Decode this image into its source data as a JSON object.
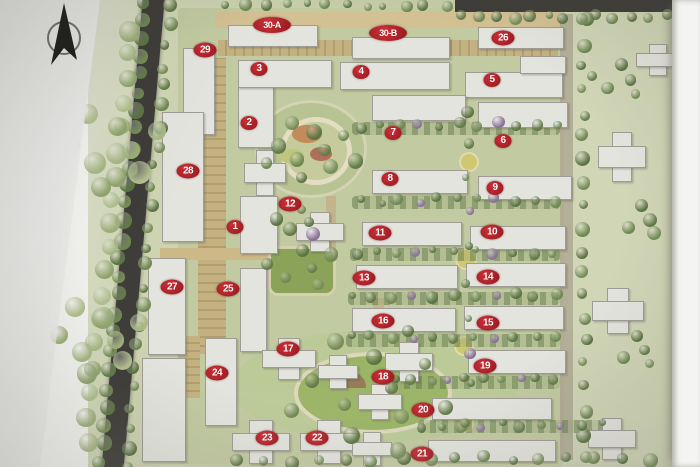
{
  "photo": {
    "kind": "residential-community-master-plan-photo",
    "compass": "north-arrow",
    "paper_color": "#f2f2ef",
    "colors": {
      "marker_red": "#a01d24",
      "marker_text": "#ffffff",
      "road_dark": "#3b3933",
      "ground_green": "#c8d2a0",
      "east_green": "#d6dcb4",
      "building_white": "#ebeae3",
      "tan_road": "#d6bc7d",
      "lawn_green": "#87a848",
      "tree_green": "#5e7c3c"
    }
  },
  "map": {
    "markers": [
      {
        "label": "1",
        "x": 235,
        "y": 227
      },
      {
        "label": "2",
        "x": 249,
        "y": 123
      },
      {
        "label": "3",
        "x": 259,
        "y": 69
      },
      {
        "label": "4",
        "x": 361,
        "y": 72
      },
      {
        "label": "5",
        "x": 492,
        "y": 80
      },
      {
        "label": "6",
        "x": 503,
        "y": 141
      },
      {
        "label": "7",
        "x": 393,
        "y": 133
      },
      {
        "label": "8",
        "x": 390,
        "y": 179
      },
      {
        "label": "9",
        "x": 495,
        "y": 188
      },
      {
        "label": "10",
        "x": 492,
        "y": 232
      },
      {
        "label": "11",
        "x": 380,
        "y": 233
      },
      {
        "label": "12",
        "x": 290,
        "y": 204
      },
      {
        "label": "13",
        "x": 364,
        "y": 278
      },
      {
        "label": "14",
        "x": 488,
        "y": 277
      },
      {
        "label": "15",
        "x": 488,
        "y": 323
      },
      {
        "label": "16",
        "x": 383,
        "y": 321
      },
      {
        "label": "17",
        "x": 288,
        "y": 349
      },
      {
        "label": "18",
        "x": 383,
        "y": 377
      },
      {
        "label": "19",
        "x": 485,
        "y": 366
      },
      {
        "label": "20",
        "x": 423,
        "y": 410
      },
      {
        "label": "21",
        "x": 422,
        "y": 454
      },
      {
        "label": "22",
        "x": 317,
        "y": 438
      },
      {
        "label": "23",
        "x": 267,
        "y": 438
      },
      {
        "label": "24",
        "x": 217,
        "y": 373
      },
      {
        "label": "25",
        "x": 228,
        "y": 289
      },
      {
        "label": "26",
        "x": 503,
        "y": 38
      },
      {
        "label": "27",
        "x": 172,
        "y": 287
      },
      {
        "label": "28",
        "x": 188,
        "y": 171
      },
      {
        "label": "29",
        "x": 205,
        "y": 50
      },
      {
        "label": "30-A",
        "x": 272,
        "y": 25
      },
      {
        "label": "30-B",
        "x": 388,
        "y": 33
      }
    ],
    "buildings": [
      {
        "x": 183,
        "y": 48,
        "w": 30,
        "h": 85,
        "s": "v"
      },
      {
        "x": 162,
        "y": 112,
        "w": 40,
        "h": 128,
        "s": "v"
      },
      {
        "x": 148,
        "y": 258,
        "w": 36,
        "h": 95,
        "s": "v"
      },
      {
        "x": 142,
        "y": 358,
        "w": 42,
        "h": 102,
        "s": "v"
      },
      {
        "x": 240,
        "y": 268,
        "w": 25,
        "h": 82,
        "s": "v"
      },
      {
        "x": 205,
        "y": 338,
        "w": 30,
        "h": 86,
        "s": "v"
      },
      {
        "x": 238,
        "y": 86,
        "w": 34,
        "h": 60,
        "s": "v"
      },
      {
        "x": 244,
        "y": 150,
        "w": 40,
        "h": 44,
        "s": "x"
      },
      {
        "x": 240,
        "y": 196,
        "w": 36,
        "h": 56,
        "s": "v"
      },
      {
        "x": 296,
        "y": 212,
        "w": 46,
        "h": 38,
        "s": "x"
      },
      {
        "x": 228,
        "y": 25,
        "w": 88,
        "h": 20,
        "s": "h"
      },
      {
        "x": 352,
        "y": 37,
        "w": 96,
        "h": 20,
        "s": "h"
      },
      {
        "x": 478,
        "y": 27,
        "w": 84,
        "h": 20,
        "s": "h"
      },
      {
        "x": 238,
        "y": 60,
        "w": 92,
        "h": 26,
        "s": "h"
      },
      {
        "x": 340,
        "y": 62,
        "w": 108,
        "h": 26,
        "s": "h"
      },
      {
        "x": 465,
        "y": 72,
        "w": 96,
        "h": 24,
        "s": "h"
      },
      {
        "x": 520,
        "y": 56,
        "w": 44,
        "h": 16,
        "s": "h"
      },
      {
        "x": 372,
        "y": 95,
        "w": 92,
        "h": 24,
        "s": "h"
      },
      {
        "x": 478,
        "y": 102,
        "w": 88,
        "h": 24,
        "s": "h"
      },
      {
        "x": 372,
        "y": 170,
        "w": 94,
        "h": 22,
        "s": "h"
      },
      {
        "x": 478,
        "y": 176,
        "w": 92,
        "h": 22,
        "s": "h"
      },
      {
        "x": 362,
        "y": 222,
        "w": 98,
        "h": 22,
        "s": "h"
      },
      {
        "x": 470,
        "y": 226,
        "w": 94,
        "h": 22,
        "s": "h"
      },
      {
        "x": 356,
        "y": 265,
        "w": 100,
        "h": 22,
        "s": "h"
      },
      {
        "x": 466,
        "y": 263,
        "w": 98,
        "h": 22,
        "s": "h"
      },
      {
        "x": 352,
        "y": 308,
        "w": 102,
        "h": 22,
        "s": "h"
      },
      {
        "x": 464,
        "y": 306,
        "w": 98,
        "h": 22,
        "s": "h"
      },
      {
        "x": 468,
        "y": 350,
        "w": 96,
        "h": 22,
        "s": "h"
      },
      {
        "x": 432,
        "y": 398,
        "w": 118,
        "h": 20,
        "s": "h"
      },
      {
        "x": 428,
        "y": 440,
        "w": 126,
        "h": 20,
        "s": "h"
      },
      {
        "x": 262,
        "y": 338,
        "w": 52,
        "h": 40,
        "s": "x"
      },
      {
        "x": 318,
        "y": 355,
        "w": 38,
        "h": 32,
        "s": "x"
      },
      {
        "x": 385,
        "y": 342,
        "w": 46,
        "h": 38,
        "s": "x"
      },
      {
        "x": 358,
        "y": 384,
        "w": 42,
        "h": 34,
        "s": "x"
      },
      {
        "x": 232,
        "y": 420,
        "w": 56,
        "h": 42,
        "s": "x"
      },
      {
        "x": 300,
        "y": 420,
        "w": 56,
        "h": 42,
        "s": "x"
      },
      {
        "x": 352,
        "y": 432,
        "w": 38,
        "h": 32,
        "s": "x"
      },
      {
        "x": 598,
        "y": 132,
        "w": 46,
        "h": 48,
        "s": "x"
      },
      {
        "x": 592,
        "y": 288,
        "w": 50,
        "h": 44,
        "s": "x"
      },
      {
        "x": 636,
        "y": 44,
        "w": 42,
        "h": 30,
        "s": "x"
      },
      {
        "x": 588,
        "y": 418,
        "w": 46,
        "h": 40,
        "s": "x"
      }
    ],
    "tree_lines": [
      {
        "x1": 146,
        "y1": 0,
        "x2": 100,
        "y2": 462,
        "n": 26,
        "r": 7,
        "p": "d"
      },
      {
        "x1": 171,
        "y1": 6,
        "x2": 125,
        "y2": 466,
        "n": 24,
        "r": 6,
        "p": "d"
      },
      {
        "x1": 131,
        "y1": 30,
        "x2": 86,
        "y2": 440,
        "n": 18,
        "r": 9,
        "p": "l"
      },
      {
        "x1": 584,
        "y1": 22,
        "x2": 584,
        "y2": 456,
        "n": 20,
        "r": 6,
        "p": "d"
      },
      {
        "x1": 462,
        "y1": 16,
        "x2": 665,
        "y2": 16,
        "n": 13,
        "r": 5,
        "p": "d"
      },
      {
        "x1": 225,
        "y1": 6,
        "x2": 445,
        "y2": 6,
        "n": 12,
        "r": 5,
        "p": "d"
      },
      {
        "x1": 360,
        "y1": 127,
        "x2": 555,
        "y2": 123,
        "n": 11,
        "r": 5,
        "p": "g"
      },
      {
        "x1": 360,
        "y1": 201,
        "x2": 555,
        "y2": 199,
        "n": 11,
        "r": 5,
        "p": "g"
      },
      {
        "x1": 355,
        "y1": 253,
        "x2": 555,
        "y2": 251,
        "n": 11,
        "r": 5,
        "p": "g"
      },
      {
        "x1": 352,
        "y1": 296,
        "x2": 555,
        "y2": 294,
        "n": 11,
        "r": 5,
        "p": "g"
      },
      {
        "x1": 350,
        "y1": 338,
        "x2": 555,
        "y2": 336,
        "n": 11,
        "r": 5,
        "p": "g"
      },
      {
        "x1": 395,
        "y1": 381,
        "x2": 555,
        "y2": 379,
        "n": 10,
        "r": 5,
        "p": "g"
      },
      {
        "x1": 420,
        "y1": 426,
        "x2": 600,
        "y2": 424,
        "n": 10,
        "r": 5,
        "p": "g"
      },
      {
        "x1": 235,
        "y1": 460,
        "x2": 650,
        "y2": 458,
        "n": 16,
        "r": 6,
        "p": "d"
      },
      {
        "x1": 468,
        "y1": 110,
        "x2": 468,
        "y2": 420,
        "n": 10,
        "r": 5,
        "p": "g"
      }
    ],
    "tree_clusters": [
      {
        "cx": 312,
        "cy": 150,
        "n": 10,
        "sp": 50,
        "r": 7,
        "p": "d"
      },
      {
        "cx": 370,
        "cy": 388,
        "n": 12,
        "sp": 95,
        "r": 7,
        "p": "d"
      },
      {
        "cx": 300,
        "cy": 268,
        "n": 6,
        "sp": 38,
        "r": 6,
        "p": "d"
      },
      {
        "cx": 620,
        "cy": 80,
        "n": 5,
        "sp": 30,
        "r": 6,
        "p": "d"
      },
      {
        "cx": 115,
        "cy": 150,
        "n": 8,
        "sp": 60,
        "r": 10,
        "p": "l"
      },
      {
        "cx": 100,
        "cy": 340,
        "n": 8,
        "sp": 55,
        "r": 10,
        "p": "l"
      },
      {
        "cx": 300,
        "cy": 222,
        "n": 5,
        "sp": 25,
        "r": 6,
        "p": "g"
      },
      {
        "cx": 640,
        "cy": 220,
        "n": 4,
        "sp": 25,
        "r": 6,
        "p": "d"
      },
      {
        "cx": 635,
        "cy": 350,
        "n": 4,
        "sp": 25,
        "r": 6,
        "p": "d"
      }
    ],
    "axis_nodes": [
      {
        "x": 467,
        "y": 160,
        "r": 8
      },
      {
        "x": 464,
        "y": 257,
        "r": 9
      },
      {
        "x": 462,
        "y": 344,
        "r": 8
      },
      {
        "x": 462,
        "y": 421,
        "r": 8
      }
    ]
  }
}
